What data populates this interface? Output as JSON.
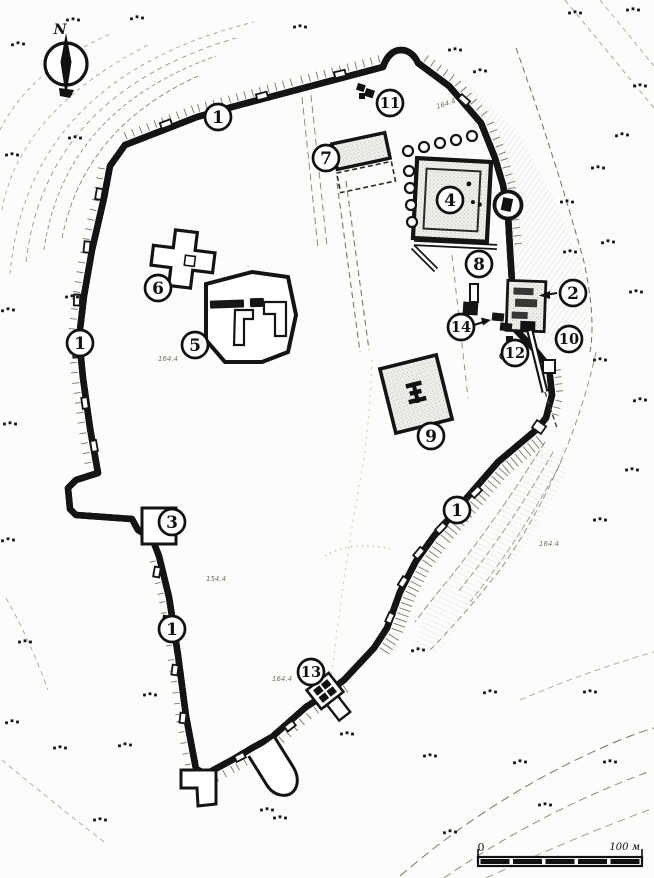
{
  "compass": {
    "north_label": "N"
  },
  "scale_bar": {
    "start_label": "0",
    "end_label": "100 м"
  },
  "markers": [
    {
      "label": "1",
      "id": "wall-north",
      "x": 218,
      "y": 117
    },
    {
      "label": "11",
      "id": "structure-11",
      "x": 390,
      "y": 103
    },
    {
      "label": "7",
      "id": "building-7",
      "x": 326,
      "y": 158
    },
    {
      "label": "4",
      "id": "building-4",
      "x": 450,
      "y": 200
    },
    {
      "label": "6",
      "id": "church-6",
      "x": 158,
      "y": 288
    },
    {
      "label": "1",
      "id": "wall-west",
      "x": 80,
      "y": 343
    },
    {
      "label": "5",
      "id": "enclosure-5",
      "x": 195,
      "y": 345
    },
    {
      "label": "8",
      "id": "feature-8",
      "x": 479,
      "y": 264
    },
    {
      "label": "2",
      "id": "east-gate-2",
      "x": 573,
      "y": 293
    },
    {
      "label": "14",
      "id": "feature-14",
      "x": 461,
      "y": 327
    },
    {
      "label": "10",
      "id": "feature-10",
      "x": 569,
      "y": 339
    },
    {
      "label": "12",
      "id": "feature-12",
      "x": 515,
      "y": 353
    },
    {
      "label": "9",
      "id": "building-9",
      "x": 431,
      "y": 436
    },
    {
      "label": "1",
      "id": "wall-southeast",
      "x": 457,
      "y": 510
    },
    {
      "label": "3",
      "id": "tower-3",
      "x": 172,
      "y": 522
    },
    {
      "label": "1",
      "id": "wall-southwest",
      "x": 172,
      "y": 629
    },
    {
      "label": "13",
      "id": "south-gate-13",
      "x": 311,
      "y": 672
    }
  ],
  "vegetation_dot_groups": [
    [
      75,
      138
    ],
    [
      73,
      20
    ],
    [
      137,
      18
    ],
    [
      300,
      27
    ],
    [
      455,
      50
    ],
    [
      480,
      71
    ],
    [
      575,
      13
    ],
    [
      633,
      10
    ],
    [
      18,
      44
    ],
    [
      12,
      155
    ],
    [
      640,
      86
    ],
    [
      622,
      135
    ],
    [
      598,
      168
    ],
    [
      567,
      202
    ],
    [
      608,
      242
    ],
    [
      570,
      252
    ],
    [
      636,
      292
    ],
    [
      8,
      310
    ],
    [
      72,
      297
    ],
    [
      600,
      360
    ],
    [
      640,
      400
    ],
    [
      632,
      470
    ],
    [
      10,
      424
    ],
    [
      8,
      540
    ],
    [
      600,
      520
    ],
    [
      25,
      642
    ],
    [
      12,
      722
    ],
    [
      60,
      748
    ],
    [
      150,
      695
    ],
    [
      125,
      745
    ],
    [
      267,
      810
    ],
    [
      347,
      734
    ],
    [
      418,
      650
    ],
    [
      100,
      820
    ],
    [
      280,
      818
    ],
    [
      450,
      832
    ],
    [
      545,
      805
    ],
    [
      610,
      762
    ],
    [
      520,
      762
    ],
    [
      430,
      756
    ],
    [
      590,
      692
    ],
    [
      490,
      692
    ]
  ],
  "spot_height_labels": [
    {
      "text": "164.4",
      "x": 437,
      "y": 109,
      "rot": -18
    },
    {
      "text": "164.4",
      "x": 158,
      "y": 361,
      "rot": 0
    },
    {
      "text": "154.4",
      "x": 206,
      "y": 581,
      "rot": 0
    },
    {
      "text": "164.4",
      "x": 272,
      "y": 681,
      "rot": 0
    },
    {
      "text": "164.4",
      "x": 539,
      "y": 546,
      "rot": 0
    }
  ]
}
